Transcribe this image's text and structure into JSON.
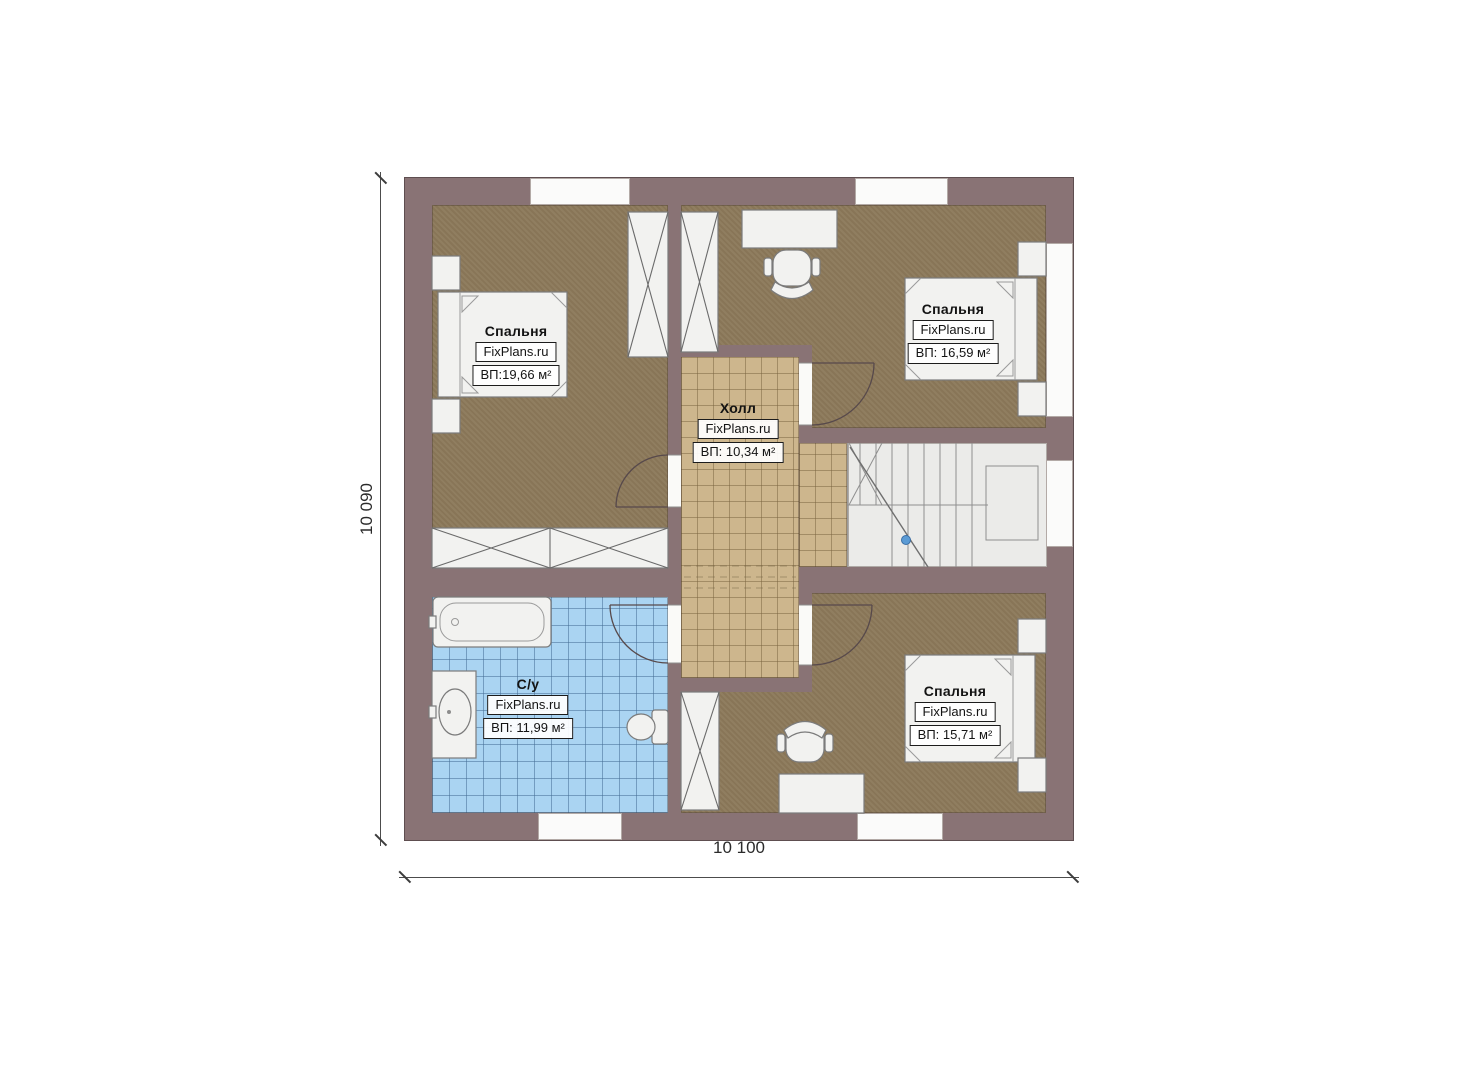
{
  "dimensions": {
    "height": "10 090",
    "width": "10 100"
  },
  "rooms": {
    "bedroom_top_left": {
      "name": "Спальня",
      "brand": "FixPlans.ru",
      "area": "ВП:19,66 м²"
    },
    "bedroom_top_right": {
      "name": "Спальня",
      "brand": "FixPlans.ru",
      "area": "ВП: 16,59 м²"
    },
    "hall": {
      "name": "Холл",
      "brand": "FixPlans.ru",
      "area": "ВП: 10,34 м²"
    },
    "bathroom": {
      "name": "С/у",
      "brand": "FixPlans.ru",
      "area": "ВП: 11,99 м²"
    },
    "bedroom_bottom_right": {
      "name": "Спальня",
      "brand": "FixPlans.ru",
      "area": "ВП: 15,71 м²"
    }
  },
  "colors": {
    "wall": "#897375",
    "bedroom_floor": "#8c795a",
    "hall_floor": "#cdb68d",
    "bath_floor": "#aad4f2",
    "stairs_floor": "#ebebe9",
    "accent_dot": "#5b9bd5"
  }
}
